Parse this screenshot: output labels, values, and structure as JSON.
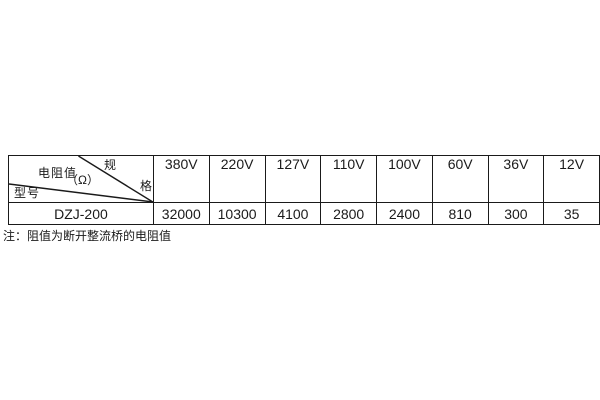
{
  "colors": {
    "background": "#ffffff",
    "border": "#1a1a1a",
    "text": "#1a1a1a"
  },
  "spec_table": {
    "corner": {
      "spec_char_top": "规",
      "spec_char_bottom": "格",
      "resistance_label": "电阻值",
      "resistance_unit": "（Ω）",
      "model_label": "型号"
    },
    "voltage_headers": [
      "380V",
      "220V",
      "127V",
      "110V",
      "100V",
      "60V",
      "36V",
      "12V"
    ],
    "model": "DZJ-200",
    "resistance_values": [
      "32000",
      "10300",
      "4100",
      "2800",
      "2400",
      "810",
      "300",
      "35"
    ]
  },
  "note": {
    "text": "注：阻值为断开整流桥的电阻值"
  }
}
